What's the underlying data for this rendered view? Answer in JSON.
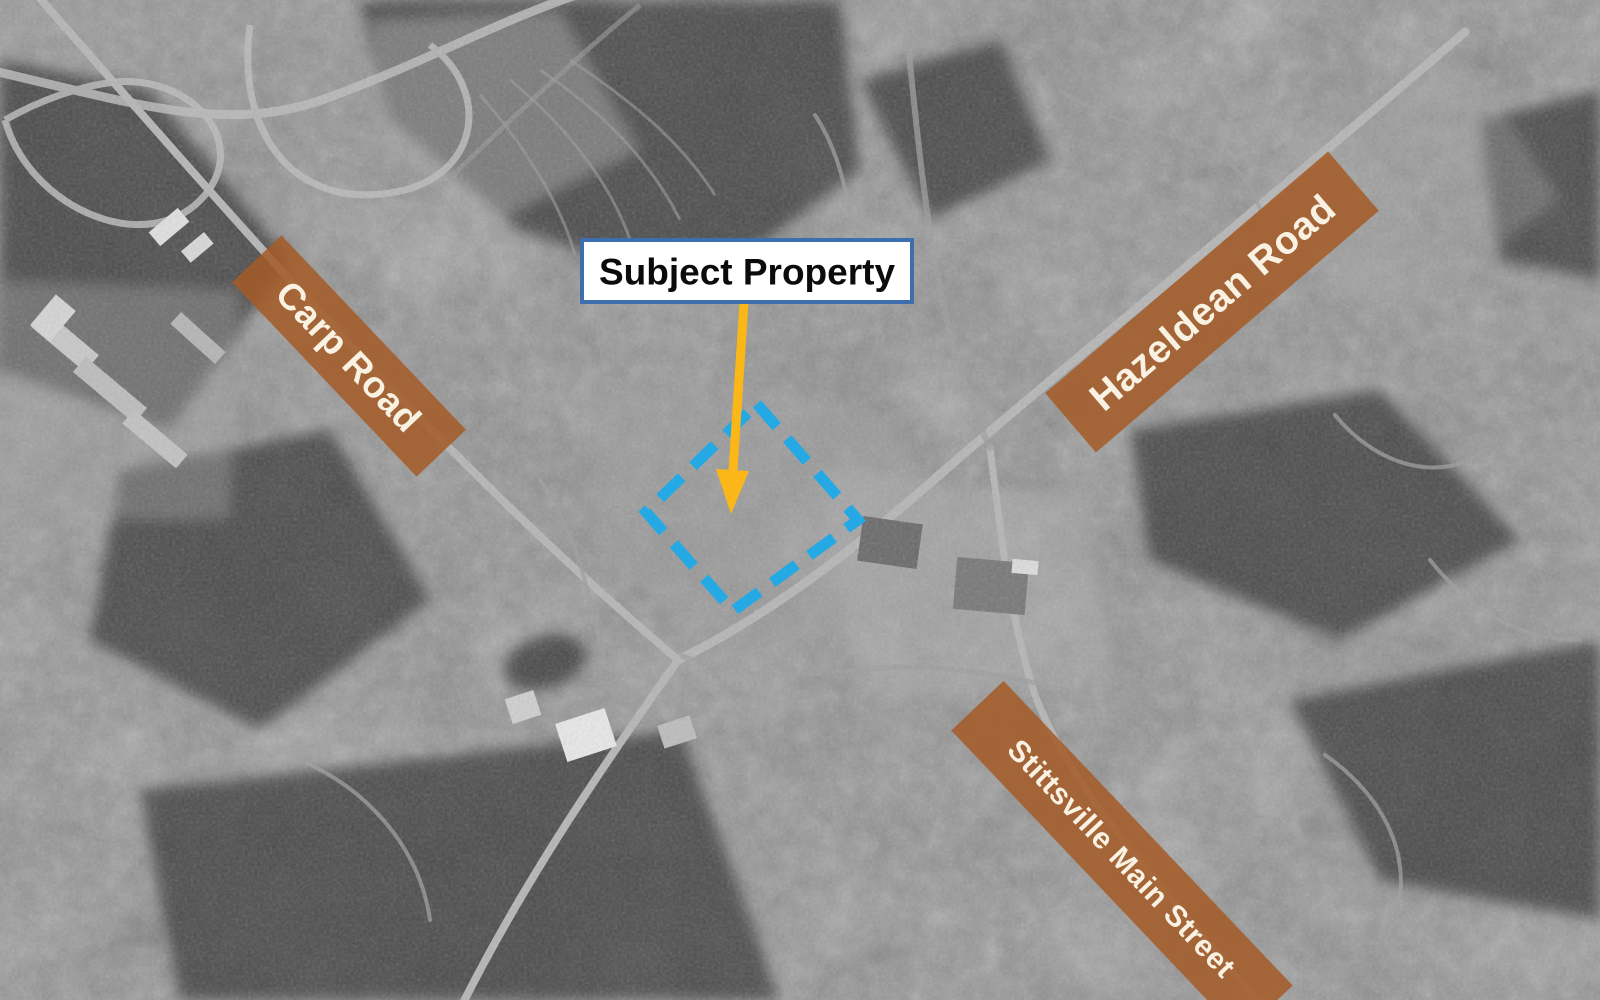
{
  "callout": {
    "label": "Subject Property"
  },
  "road_labels": [
    {
      "label": "Carp Road"
    },
    {
      "label": "Hazeldean Road"
    },
    {
      "label": "Stittsville Main Street"
    }
  ],
  "property_outline": {
    "style": "dashed-square"
  },
  "colors": {
    "banner": "#A45B27",
    "banner_text": "#F9F1E2",
    "outline": "#24A9E4",
    "arrow": "#FBB617",
    "callout_border": "#3D6FAF",
    "callout_bg": "#FFFFFF",
    "callout_text": "#0B0B0B"
  }
}
